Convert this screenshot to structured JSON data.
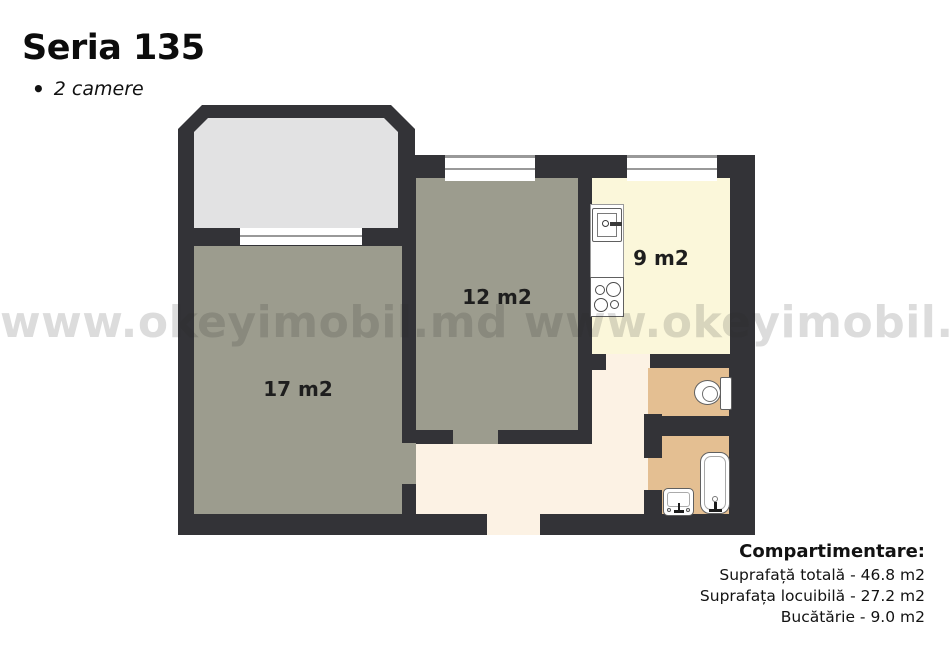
{
  "header": {
    "title": "Seria 135",
    "bullet": "•",
    "subtitle": "2 camere"
  },
  "watermark": "www.okeyimobil.md www.okeyimobil.md",
  "rooms": {
    "living": {
      "label": "17 m2"
    },
    "bedroom": {
      "label": "12 m2"
    },
    "kitchen": {
      "label": "9 m2"
    }
  },
  "legend": {
    "heading": "Compartimentare:",
    "lines": [
      "Suprafață totală - 46.8 m2",
      "Suprafața locuibilă - 27.2 m2",
      "Bucătărie - 9.0 m2"
    ]
  },
  "colors": {
    "wall": "#333337",
    "room": "#9c9c8e",
    "kitchen": "#fbf7da",
    "hallway": "#fcf2e4",
    "bathroom": "#e4bf92",
    "balcony": "#e2e2e3",
    "window_line": "#999999",
    "fixture_border": "#606060",
    "watermark": "rgba(40,40,40,0.165)",
    "label": "#1e1e1e",
    "text": "#121212"
  }
}
